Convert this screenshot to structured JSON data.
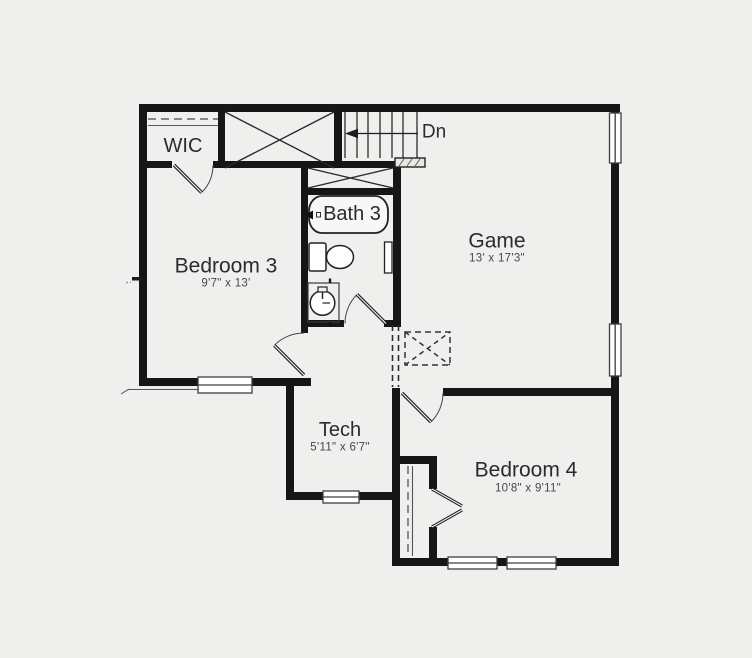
{
  "floor_plan": {
    "rooms": [
      {
        "id": "wic",
        "name": "WIC",
        "dims": ""
      },
      {
        "id": "bedroom3",
        "name": "Bedroom 3",
        "dims": "9'7\" x 13'"
      },
      {
        "id": "bath3",
        "name": "Bath 3",
        "dims": ""
      },
      {
        "id": "game",
        "name": "Game",
        "dims": "13' x 17'3\""
      },
      {
        "id": "tech",
        "name": "Tech",
        "dims": "5'11\" x 6'7\""
      },
      {
        "id": "bedroom4",
        "name": "Bedroom 4",
        "dims": "10'8\" x 9'11\""
      }
    ],
    "stair_label": "Dn",
    "fixtures": [
      "bathtub",
      "toilet",
      "sink-vanity"
    ],
    "symbols": [
      "closet-x-box",
      "linen-x-box",
      "attic-access-dashed-box",
      "stair-railing",
      "door-swing",
      "window",
      "closet-rod-dashed"
    ],
    "colors": {
      "wall": "#161616",
      "background": "#efefee",
      "line": "#2d2d2d",
      "label_text": "#2b2b2b",
      "dim_text": "#474747",
      "window_fill": "#ffffff"
    }
  }
}
